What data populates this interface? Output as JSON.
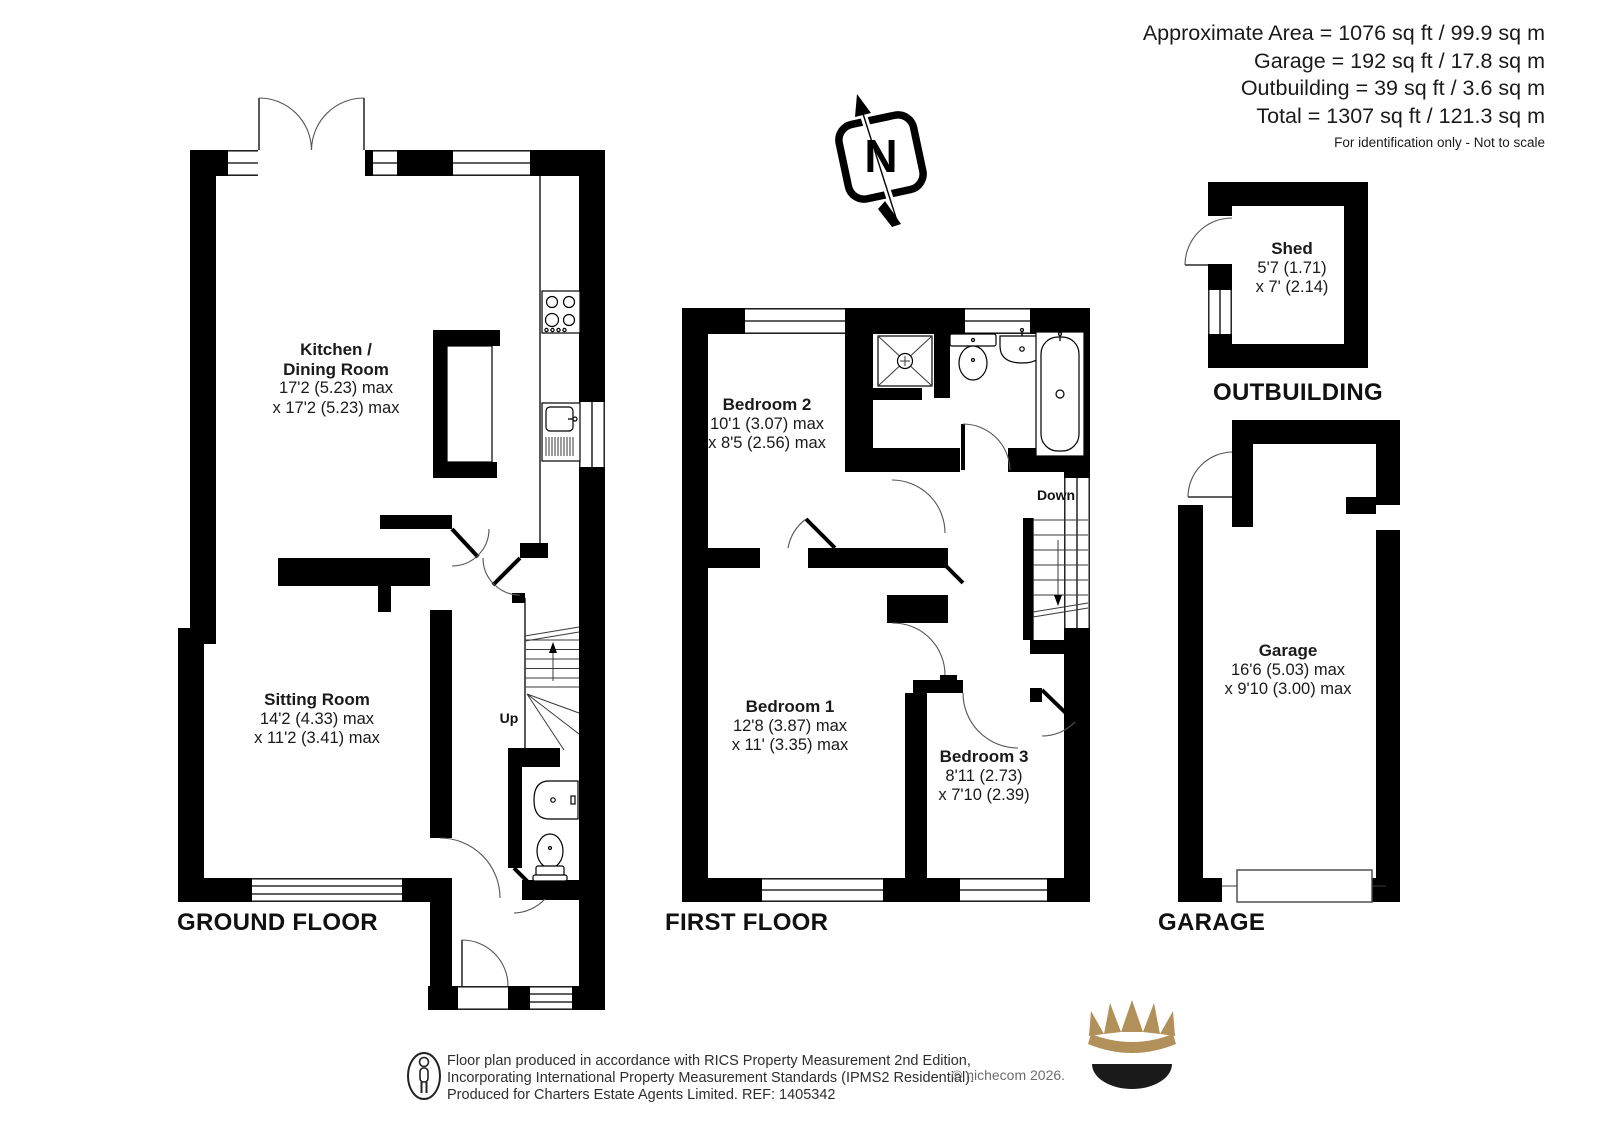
{
  "header": {
    "area_line1": "Approximate Area = 1076 sq ft / 99.9 sq m",
    "area_line2": "Garage = 192 sq ft / 17.8 sq m",
    "area_line3": "Outbuilding = 39 sq ft / 3.6 sq m",
    "area_line4": "Total = 1307 sq ft / 121.3 sq m",
    "disclaimer": "For identification only - Not to scale"
  },
  "compass": {
    "north_label": "N"
  },
  "ground_floor": {
    "label": "GROUND FLOOR",
    "kitchen_dining": {
      "name_line1": "Kitchen /",
      "name_line2": "Dining Room",
      "dim_line1": "17'2 (5.23) max",
      "dim_line2": "x 17'2 (5.23) max"
    },
    "sitting_room": {
      "name": "Sitting Room",
      "dim_line1": "14'2 (4.33) max",
      "dim_line2": "x 11'2 (3.41) max"
    },
    "stairs_label": "Up"
  },
  "first_floor": {
    "label": "FIRST FLOOR",
    "bedroom_1": {
      "name": "Bedroom 1",
      "dim_line1": "12'8 (3.87) max",
      "dim_line2": "x 11' (3.35) max"
    },
    "bedroom_2": {
      "name": "Bedroom 2",
      "dim_line1": "10'1 (3.07) max",
      "dim_line2": "x 8'5 (2.56) max"
    },
    "bedroom_3": {
      "name": "Bedroom 3",
      "dim_line1": "8'11 (2.73)",
      "dim_line2": "x 7'10 (2.39)"
    },
    "stairs_label": "Down"
  },
  "outbuilding": {
    "label": "OUTBUILDING",
    "shed": {
      "name": "Shed",
      "dim_line1": "5'7 (1.71)",
      "dim_line2": "x 7' (2.14)"
    }
  },
  "garage_building": {
    "label": "GARAGE",
    "garage": {
      "name": "Garage",
      "dim_line1": "16'6 (5.03) max",
      "dim_line2": "x 9'10 (3.00) max"
    }
  },
  "footer": {
    "line1": "Floor plan produced in accordance with RICS Property Measurement 2nd Edition,",
    "line2": "Incorporating International Property Measurement Standards (IPMS2 Residential).",
    "line3": "Produced for Charters Estate Agents Limited.   REF: 1405342",
    "copyright": "© nichecom 2026."
  },
  "colors": {
    "wall": "#000000",
    "text": "#1a1a1a",
    "crown_gold": "#b1905a",
    "copyright_gray": "#6e6e6e"
  }
}
